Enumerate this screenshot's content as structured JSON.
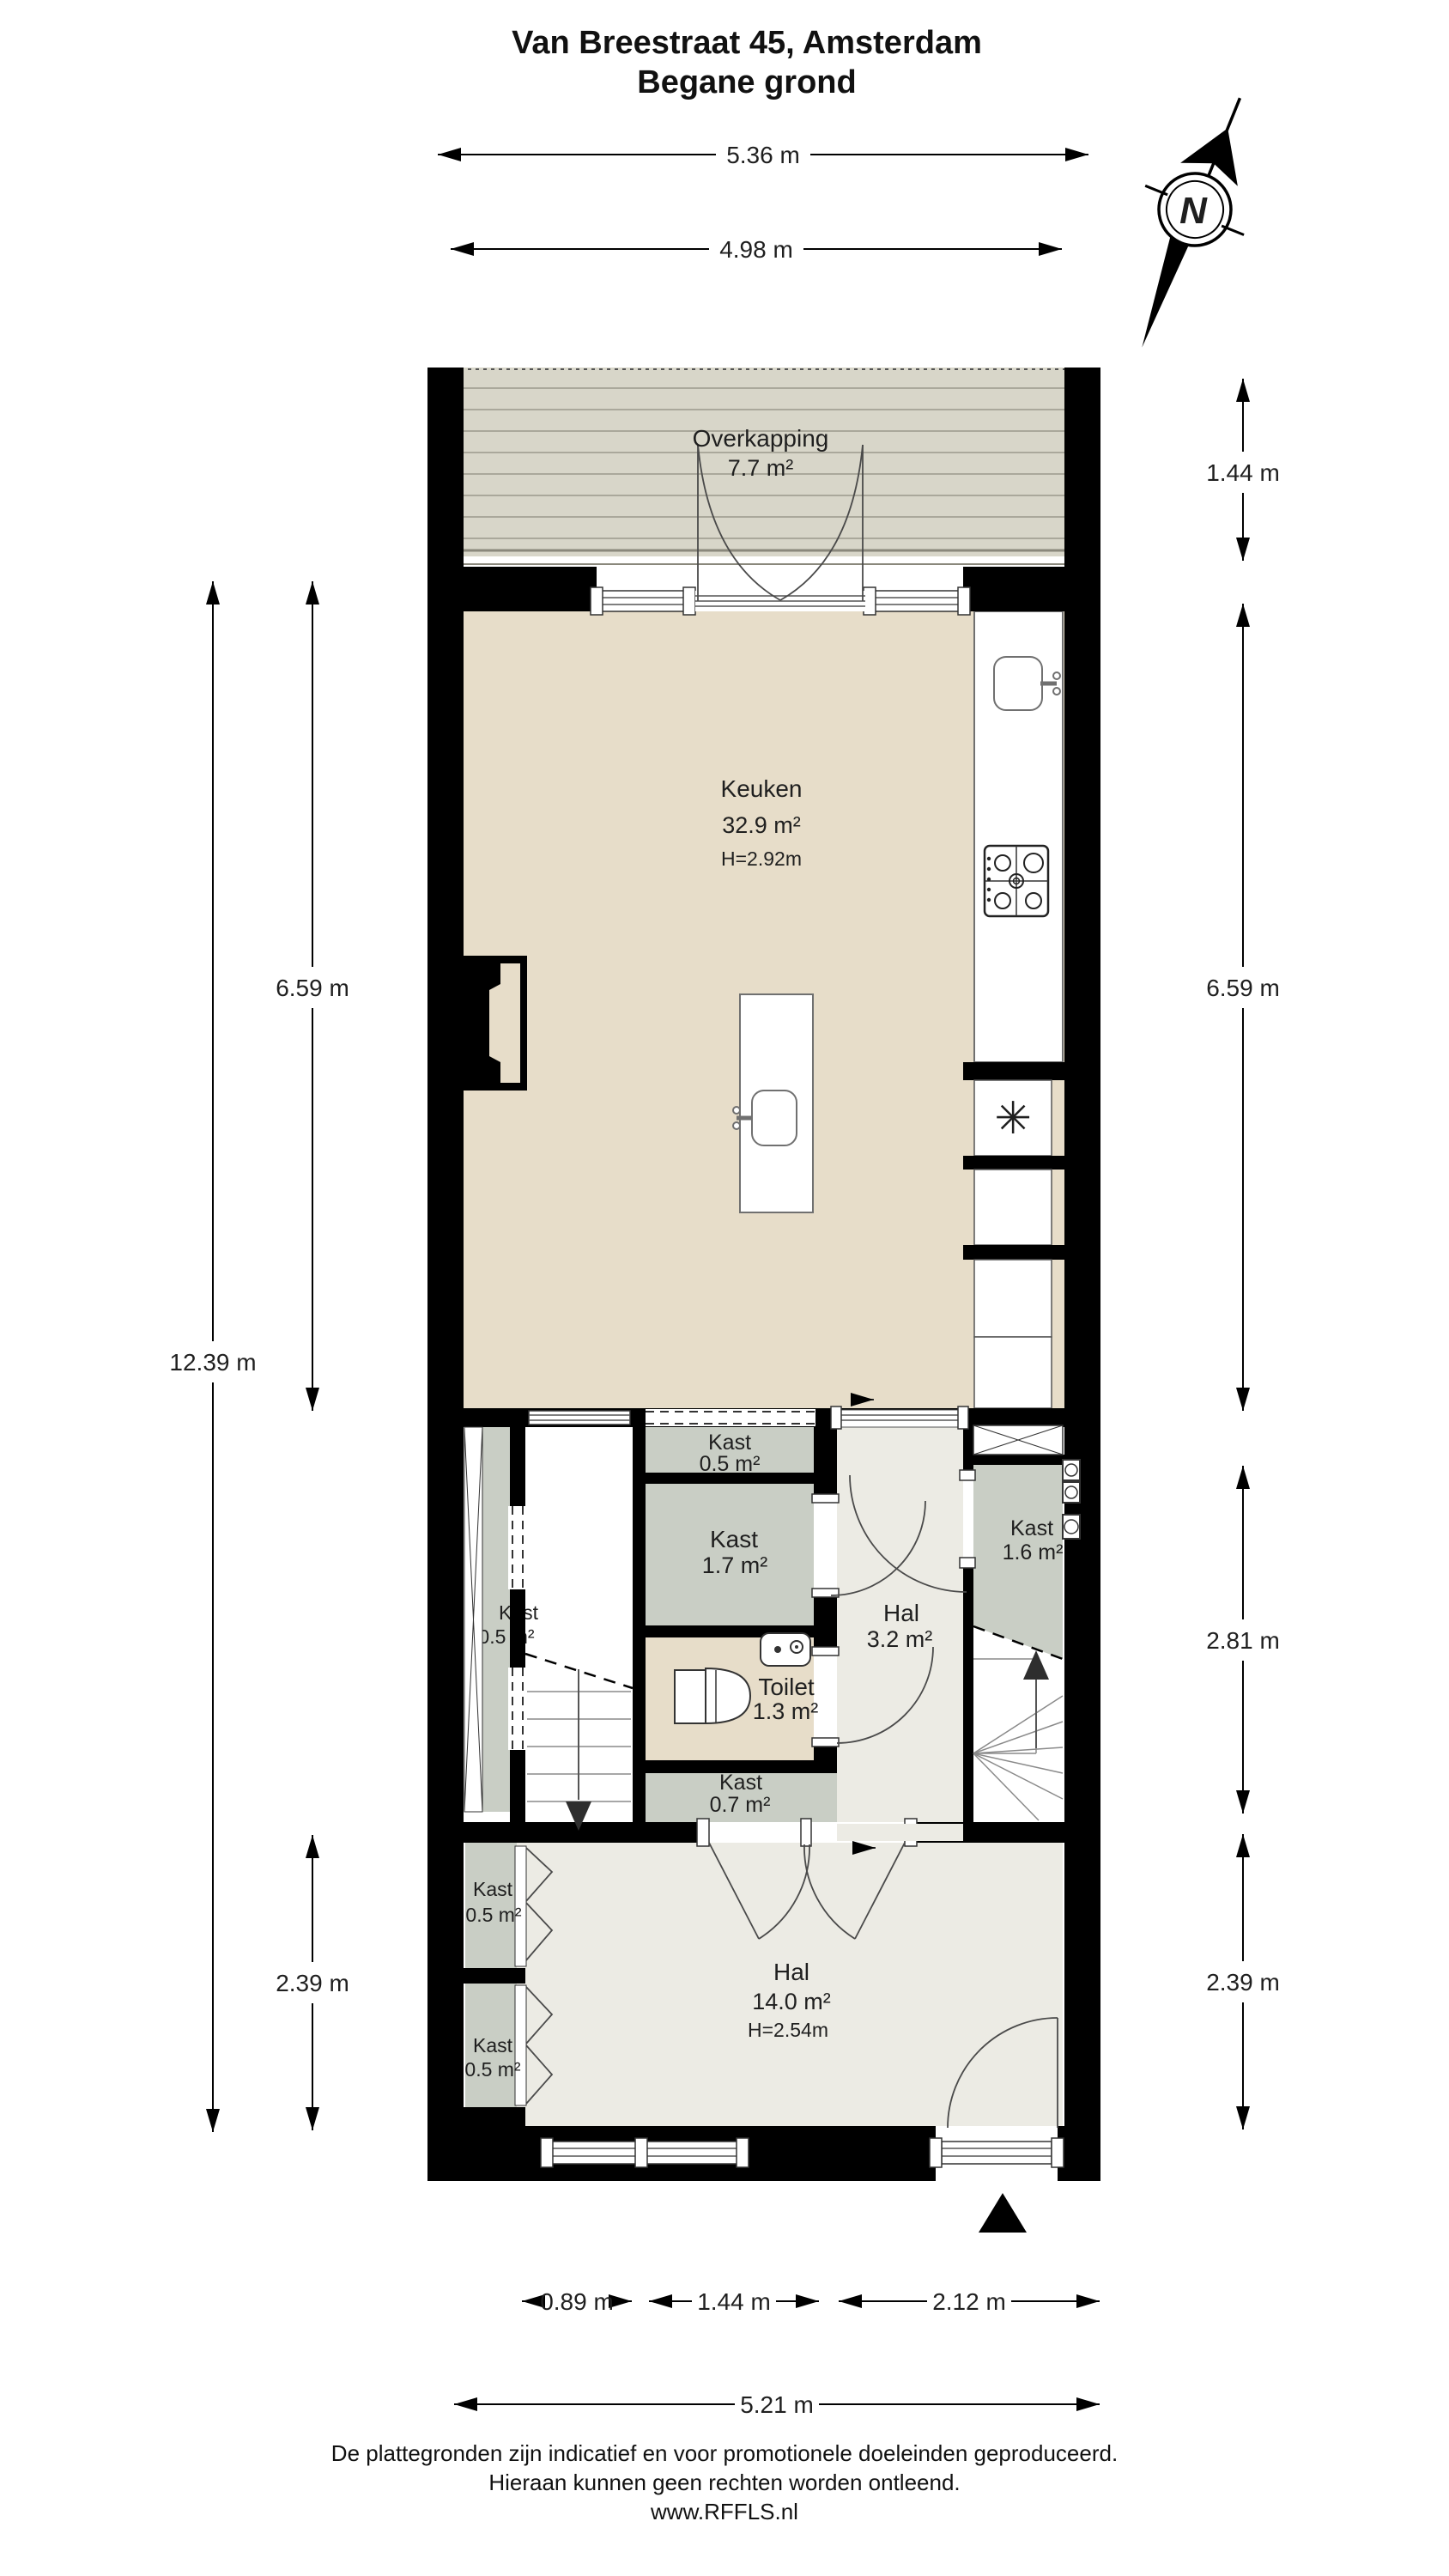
{
  "title": {
    "line1": "Van Breestraat 45, Amsterdam",
    "line2": "Begane grond"
  },
  "compass": {
    "label": "N"
  },
  "rooms": {
    "overkapping": {
      "name": "Overkapping",
      "area": "7.7 m²"
    },
    "keuken": {
      "name": "Keuken",
      "area": "32.9 m²",
      "height": "H=2.92m"
    },
    "kast_keuken": {
      "name": "Kast",
      "area": "0.5 m²"
    },
    "kast_17": {
      "name": "Kast",
      "area": "1.7 m²"
    },
    "kast_16": {
      "name": "Kast",
      "area": "1.6 m²"
    },
    "kast_strip": {
      "name": "Kast",
      "area": "0.5 m²"
    },
    "hal_boven": {
      "name": "Hal",
      "area": "3.2 m²"
    },
    "toilet": {
      "name": "Toilet",
      "area": "1.3 m²"
    },
    "kast_07": {
      "name": "Kast",
      "area": "0.7 m²"
    },
    "hal": {
      "name": "Hal",
      "area": "14.0 m²",
      "height": "H=2.54m"
    },
    "kast_hal_1": {
      "name": "Kast",
      "area": "0.5 m²"
    },
    "kast_hal_2": {
      "name": "Kast",
      "area": "0.5 m²"
    }
  },
  "dimensions": {
    "top_outer": "5.36 m",
    "top_inner": "4.98 m",
    "right_overkapping": "1.44 m",
    "right_keuken": "6.59 m",
    "right_middle": "2.81 m",
    "right_hal": "2.39 m",
    "left_keuken": "6.59 m",
    "left_total": "12.39 m",
    "left_hal": "2.39 m",
    "bottom_kast": "0.89 m",
    "bottom_stairs": "1.44 m",
    "bottom_door": "2.12 m",
    "bottom_total": "5.21 m"
  },
  "footer": {
    "line1": "De plattegronden zijn indicatief en voor promotionele doeleinden geproduceerd.",
    "line2": "Hieraan kunnen geen rechten worden ontleend.",
    "line3": "www.RFFLS.nl"
  },
  "colors": {
    "wall": "#000000",
    "keuken_floor": "#e7ddc9",
    "hal_floor": "#ecebe4",
    "kast_floor": "#c9cec5",
    "deck": "#d8d6c9",
    "white": "#ffffff"
  }
}
